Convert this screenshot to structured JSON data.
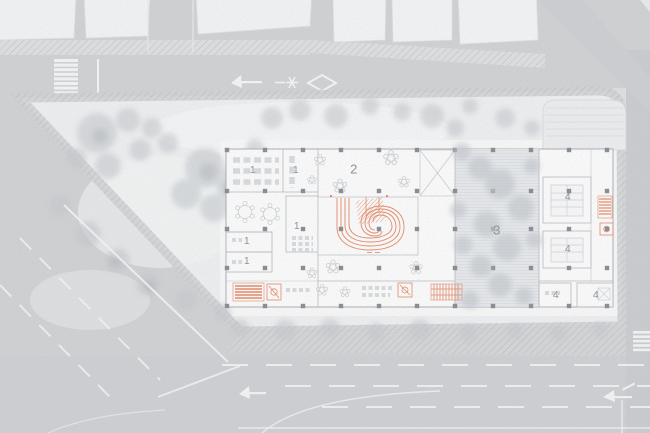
{
  "plan": {
    "title": "ground-floor site plan",
    "room_labels": [
      {
        "key": "room-1-a",
        "text": "1",
        "x": 253,
        "y": 170,
        "size": 10.5
      },
      {
        "key": "room-1-b",
        "text": "1",
        "x": 296,
        "y": 170,
        "size": 10.5
      },
      {
        "key": "room-1-c",
        "text": "1",
        "x": 297,
        "y": 226,
        "size": 10.5
      },
      {
        "key": "room-1-d",
        "text": "1",
        "x": 247,
        "y": 241,
        "size": 10.5
      },
      {
        "key": "room-1-e",
        "text": "1",
        "x": 247,
        "y": 261,
        "size": 10.5
      },
      {
        "key": "hall-2",
        "text": "2",
        "x": 354,
        "y": 169,
        "size": 13
      },
      {
        "key": "court-3",
        "text": "3",
        "x": 497,
        "y": 230,
        "size": 13
      },
      {
        "key": "room-4-a",
        "text": "4",
        "x": 568,
        "y": 197,
        "size": 10.5
      },
      {
        "key": "room-4-b",
        "text": "4",
        "x": 568,
        "y": 249,
        "size": 10.5
      },
      {
        "key": "room-4-c",
        "text": "4",
        "x": 556,
        "y": 295,
        "size": 10.5
      },
      {
        "key": "room-4-d",
        "text": "4",
        "x": 596,
        "y": 295,
        "size": 10.5
      }
    ],
    "road_markings": {
      "top": [
        "left-turn-arrow",
        "lane-arrow-symbol",
        "diamond-marking"
      ],
      "bottom": [
        "left-turn-arrow",
        "merge-arrow"
      ],
      "crosswalks": [
        "top-left",
        "right-edge"
      ]
    },
    "colors": {
      "accent_orange": "#E9855F",
      "road_gray": "#D2D3D5",
      "site_ground": "#F1F2F3",
      "building_fill": "#FFFFFF",
      "wall_line": "#B6BAC0",
      "column_dark": "#868A90",
      "label_gray": "#8B8F96",
      "tree_gray": "#C6CACF"
    }
  }
}
